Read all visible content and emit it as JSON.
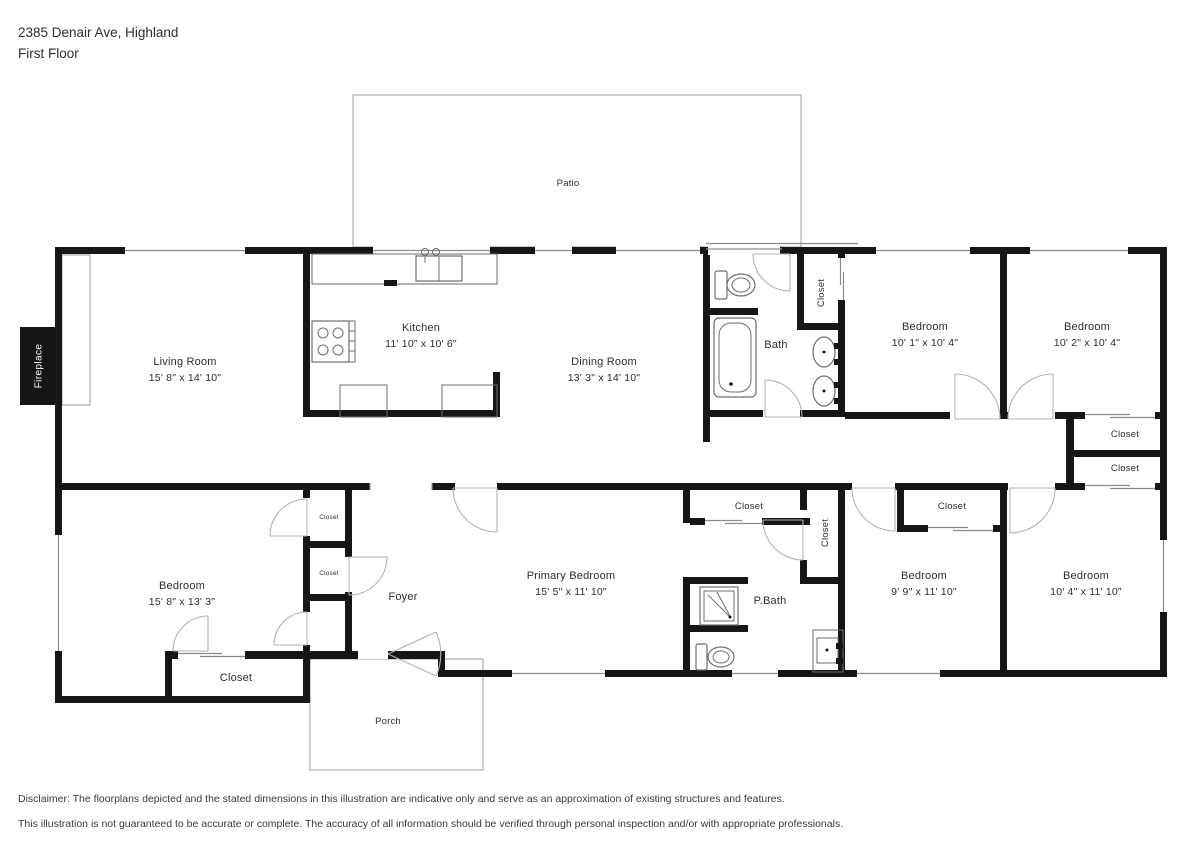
{
  "header": {
    "address": "2385 Denair Ave, Highland",
    "floor": "First Floor"
  },
  "rooms": {
    "patio": {
      "name": "Patio"
    },
    "living": {
      "name": "Living Room",
      "dims": "15' 8\" x 14' 10\""
    },
    "kitchen": {
      "name": "Kitchen",
      "dims": "11' 10\" x 10' 6\""
    },
    "dining": {
      "name": "Dining Room",
      "dims": "13' 3\" x 14' 10\""
    },
    "bath": {
      "name": "Bath"
    },
    "closet_bath": {
      "name": "Closet"
    },
    "bedroom_tl": {
      "name": "Bedroom",
      "dims": "10' 1\" x 10' 4\""
    },
    "bedroom_tr": {
      "name": "Bedroom",
      "dims": "10' 2\" x 10' 4\""
    },
    "closet_r1": {
      "name": "Closet"
    },
    "closet_r2": {
      "name": "Closet"
    },
    "bedroom_bl": {
      "name": "Bedroom",
      "dims": "15' 8\" x 13' 3\""
    },
    "closet_s1": {
      "name": "Closet"
    },
    "closet_s2": {
      "name": "Closet"
    },
    "foyer": {
      "name": "Foyer"
    },
    "closet_bl": {
      "name": "Closet"
    },
    "porch": {
      "name": "Porch"
    },
    "primary": {
      "name": "Primary Bedroom",
      "dims": "15' 5\" x 11' 10\""
    },
    "closet_primary": {
      "name": "Closet"
    },
    "closet_hall": {
      "name": "Closet"
    },
    "pbath": {
      "name": "P.Bath"
    },
    "bedroom_b1": {
      "name": "Bedroom",
      "dims": "9' 9\" x 11' 10\""
    },
    "closet_b1": {
      "name": "Closet"
    },
    "bedroom_br": {
      "name": "Bedroom",
      "dims": "10' 4\" x 11' 10\""
    },
    "fireplace": {
      "name": "Fireplace"
    }
  },
  "disclaimer": {
    "line1": "Disclaimer: The floorplans depicted and the stated dimensions in this illustration are indicative only and serve as an approximation of existing structures and features.",
    "line2": "This illustration is not guaranteed to be accurate or complete. The accuracy of all information should be verified through personal inspection and/or with appropriate professionals."
  },
  "colors": {
    "wall": "#161616",
    "window_line": "#8c8c8c",
    "outline": "#9c9c9c",
    "text": "#2d2d2d"
  }
}
